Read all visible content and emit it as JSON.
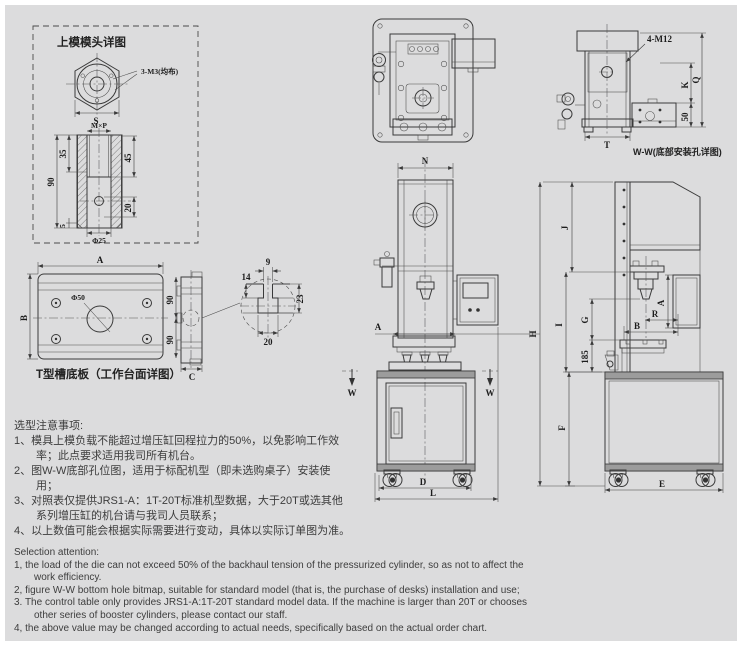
{
  "page": {
    "bg": "#ffffff",
    "sheet_bg": "#dcdcdd",
    "line_color": "#3a3a3a",
    "text_color": "#3d3d3d"
  },
  "die_head_detail": {
    "title": "上模模头详图",
    "thread_callout": "3-M3(均布)",
    "dim_s": "S",
    "dim_thread": "M×P",
    "dim_35": "35",
    "dim_45": "45",
    "dim_90": "90",
    "dim_5": "5",
    "dim_20": "20",
    "dim_dia25": "Φ25"
  },
  "tslot_plate": {
    "caption": "T型槽底板（工作台面详图）",
    "dim_a": "A",
    "dim_b": "B",
    "dia50": "Φ50",
    "dim_90_top": "90",
    "dim_90_bottom": "90",
    "dim_c": "C"
  },
  "tslot_section": {
    "dim_9": "9",
    "dim_14": "14",
    "dim_23": "23",
    "dim_20": "20"
  },
  "ww_detail": {
    "caption": "W-W(底部安装孔详图)",
    "bolt_callout": "4-M12",
    "dim_k": "K",
    "dim_q": "Q",
    "dim_50": "50",
    "dim_t": "T"
  },
  "front_view": {
    "dim_n": "N",
    "dim_a": "A",
    "dim_d": "D",
    "dim_l": "L",
    "section_w_left": "W",
    "section_w_right": "W"
  },
  "side_view": {
    "dim_h": "H",
    "dim_j": "J",
    "dim_i": "I",
    "dim_g": "G",
    "dim_185": "185",
    "dim_r": "R",
    "dim_b": "B",
    "dim_a": "A",
    "dim_f": "F",
    "dim_e": "E"
  },
  "notes_cn": {
    "heading": "选型注意事项:",
    "lines": [
      "1、模具上模负载不能超过增压缸回程拉力的50%，以免影响工作效",
      "率；此点要求适用我司所有机台。",
      "2、图W-W底部孔位图，适用于标配机型（即未选购桌子）安装使",
      "用；",
      "3、对照表仅提供JRS1-A：1T-20T标准机型数据，大于20T或选其他",
      "系列增压缸的机台请与我司人员联系；",
      "4、以上数值可能会根据实际需要进行变动，具体以实际订单图为准。"
    ]
  },
  "notes_en": {
    "heading": "Selection attention:",
    "lines": [
      "1, the load of the die can not exceed 50% of the backhaul tension of the pressurized cylinder, so as not to affect the",
      "work efficiency.",
      "2, figure W-W bottom hole bitmap, suitable for standard model (that is, the purchase of desks) installation and use;",
      "3. The control table only provides JRS1-A:1T-20T standard model data. If the machine is larger than 20T or chooses",
      "other series of booster cylinders, please contact our staff.",
      "4, the above value may be changed according to actual needs, specifically based on the actual order chart."
    ]
  }
}
